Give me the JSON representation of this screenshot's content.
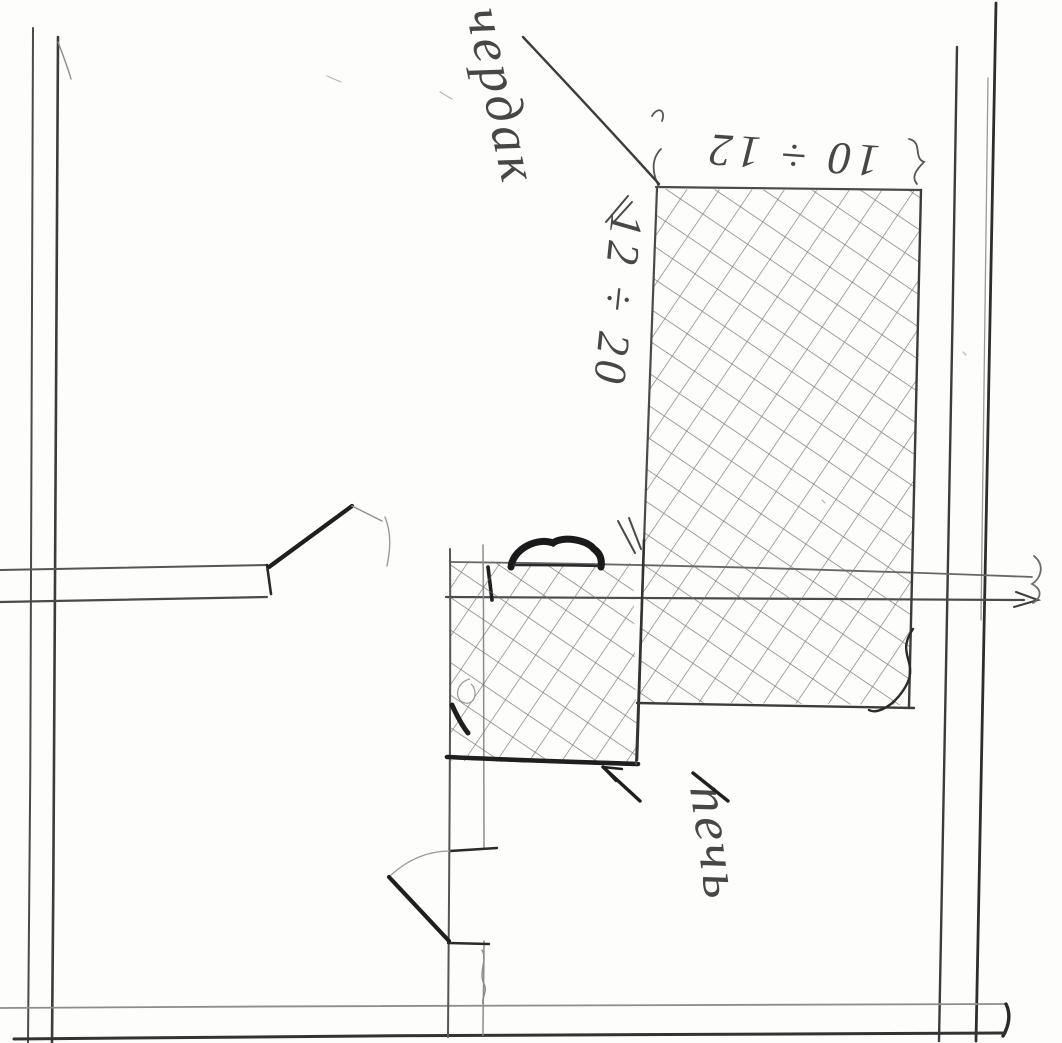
{
  "sketch": {
    "description_kind": "hand-drawn stove floor-plan sketch",
    "annotations": {
      "attic_label": "чердак",
      "stove_label": "печь",
      "dim_width": "10 ÷ 12",
      "dim_height": "12 ÷ 20"
    },
    "colors": {
      "paper": "#fdfdfb",
      "pencil_dark": "#1f1f1f",
      "pencil_mid": "#4a4a4a",
      "pencil_light": "#8d8d8d",
      "hatch_line": "#6b6b6b"
    }
  }
}
